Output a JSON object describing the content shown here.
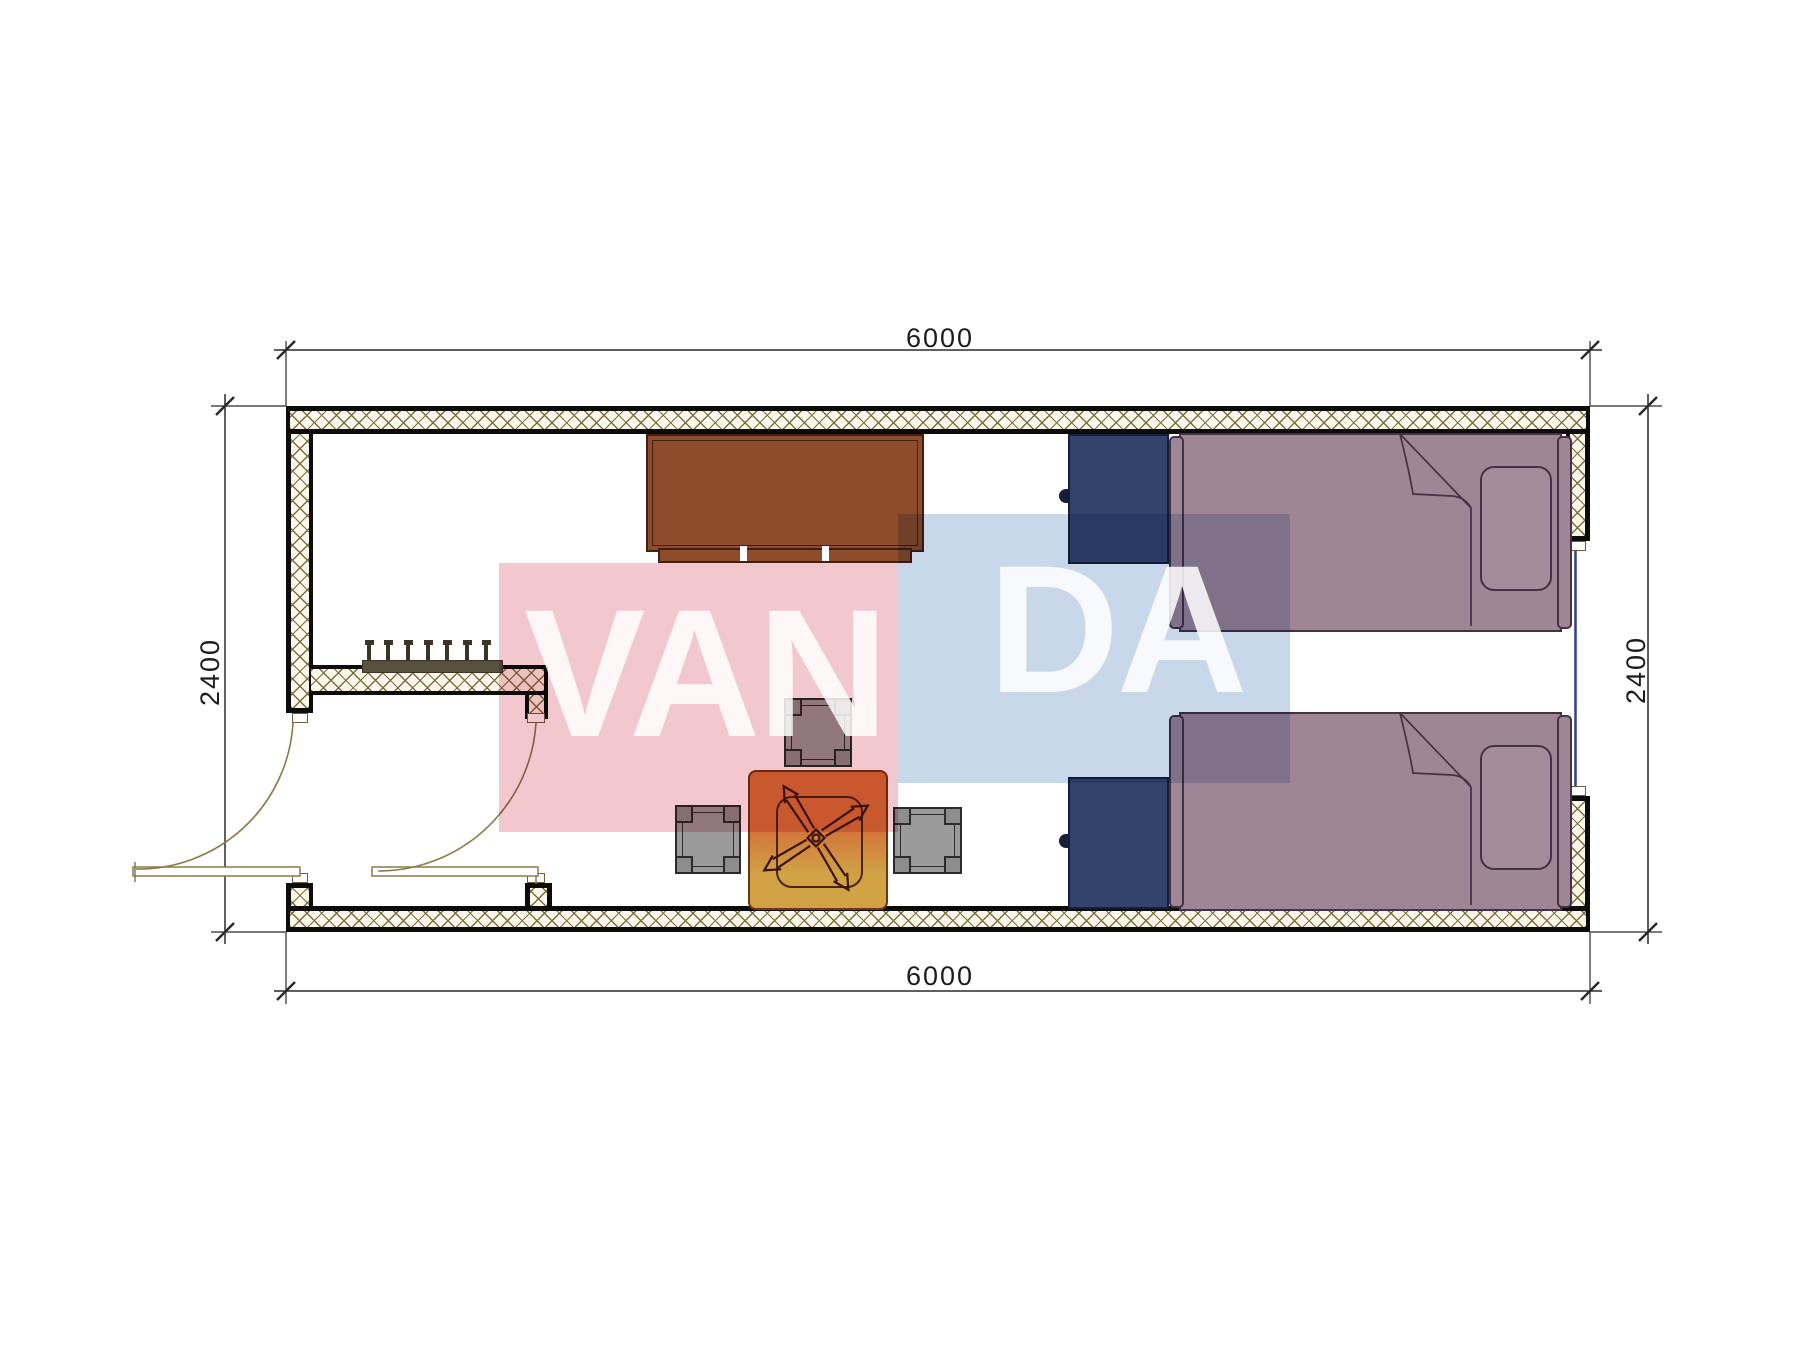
{
  "dimensions": {
    "top": "6000",
    "bottom": "6000",
    "left": "2400",
    "right": "2400"
  },
  "watermark": {
    "left_text": "VAN",
    "right_text": "DA"
  },
  "colors": {
    "wallLine": "#0b0b0b",
    "wallFill": "#fcf8ec",
    "hatchLine": "#7d6c3e",
    "dimLine": "#2a2a2a",
    "dimText": "#1c1c1c",
    "doorLine": "#8a7a4a",
    "windowLine": "#2e3f8e",
    "jambLine": "#6e5f38",
    "rackFill": "#57503c",
    "rackDark": "#3b3526",
    "deskFill": "#8f4c2c",
    "deskLine": "#3f2012",
    "wardrobeFill": "#33436e",
    "wardrobeLine": "#161f3a",
    "bedFill": "#a08694",
    "pillowFill": "#a58c9a",
    "bedLine": "#443047",
    "foldLine": "#443047",
    "stoolFill": "#9a9a9a",
    "stoolCorner": "#8d8d8d",
    "stoolLine": "#2b2b2b",
    "tableTop": "#d4703a",
    "tableBottom": "#d0a244",
    "tableLine": "#6e3413",
    "tableInner": "#4a2410",
    "fanLine": "#3a140a",
    "pinkBox": "#f2c7ce",
    "blueBox": "#c9d7ea",
    "letterColor": "rgba(255,255,255,0.85)"
  }
}
